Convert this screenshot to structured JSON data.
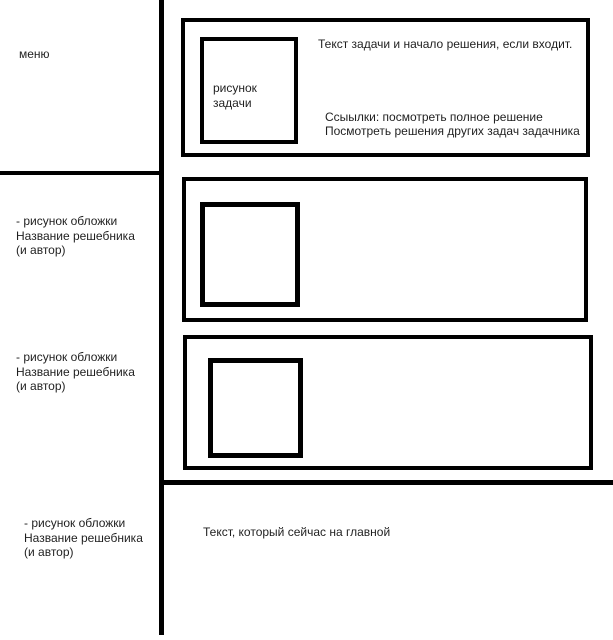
{
  "canvas": {
    "width": 613,
    "height": 640,
    "background": "#ffffff",
    "line_color": "#000000",
    "text_color": "#1f1f1f"
  },
  "sidebar": {
    "menu_label": "меню",
    "books": [
      {
        "line1": "- рисунок обложки",
        "line2": "Название решебника",
        "line3": "(и автор)"
      },
      {
        "line1": "- рисунок обложки",
        "line2": "Название решебника",
        "line3": "(и автор)"
      },
      {
        "line1": "- рисунок обложки",
        "line2": "Название решебника",
        "line3": "(и автор)"
      }
    ]
  },
  "task_card": {
    "image_placeholder_line1": "рисунок",
    "image_placeholder_line2": "задачи",
    "body_text": "Текст задачи и начало решения, если входит.",
    "links_line1": "Ссыылки: посмотреть полное решение",
    "links_line2": "Посмотреть решения других задач задачника"
  },
  "footer": {
    "text": "Текст, который сейчас на главной"
  }
}
